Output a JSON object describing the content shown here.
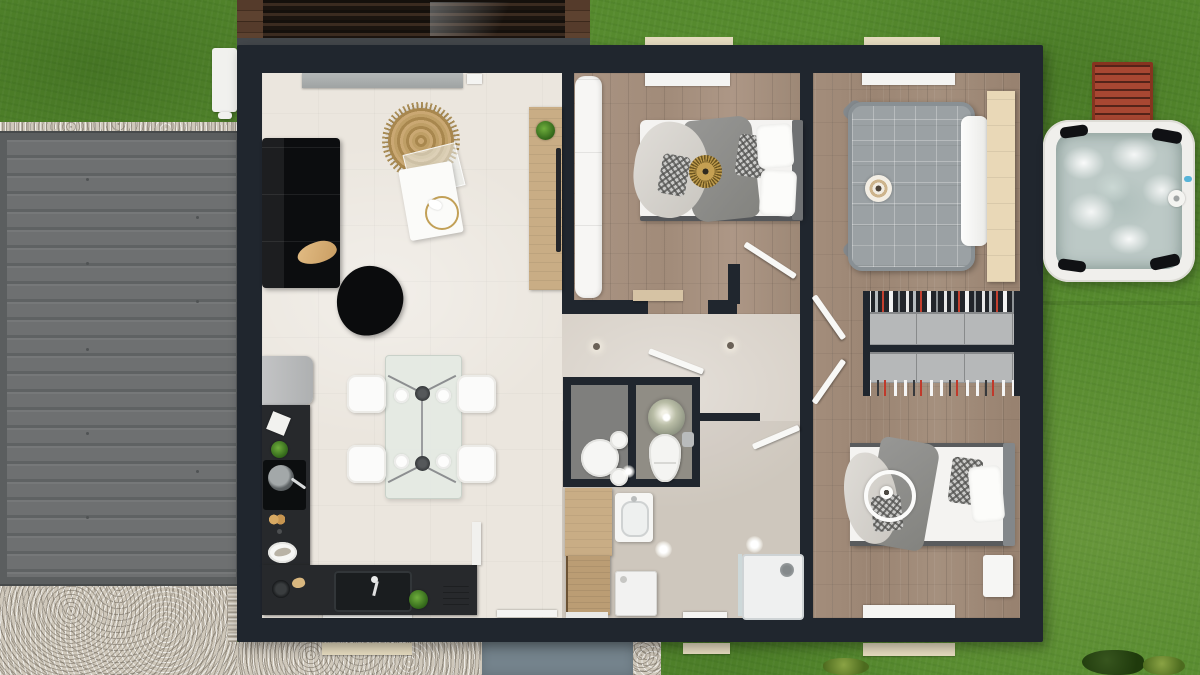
{
  "colors": {
    "grass": "#568a2e",
    "gravel": "#cfc8bb",
    "path": "#74838c",
    "wall": "#20262e",
    "floor-cream": "#ebe6de",
    "floor-hall": "#d8d1c8",
    "floor-wood": "#a08a78",
    "floor-wood-b1": "#a8927f",
    "wc-a": "#7f7f7d",
    "wc-b": "#908d85",
    "counter": "#27292c",
    "sofa": "#0c0d0f",
    "wood-furn": "#c9ad85",
    "sill": "#e6dcc0",
    "garage": "#6c6f70",
    "garage-frame": "#5b5e5f",
    "bench-red": "#a84732",
    "tub-rim": "#f0efec",
    "tub-water": "#bcc9c6",
    "wardrobe": "#b6b8b9",
    "bed-gray": "#9ba1a4",
    "gold": "#c2a057"
  },
  "scene": {
    "kind": "top-down 3d floor plan rendering of a single-storey house",
    "outdoor": {
      "items": [
        "lawn",
        "gravel-yard",
        "garage-flat-roof",
        "wood-pergola",
        "heat-pump-unit",
        "front-path",
        "hot-tub",
        "garden-bench",
        "shrubs",
        "window-sills"
      ]
    },
    "rooms": [
      {
        "name": "living-dining-kitchen",
        "floor": "cream-tile",
        "furniture": [
          "corner-sofa",
          "dog",
          "round-woven-rug",
          "coffee-table-set",
          "gold-ring-decor",
          "floor-pouf",
          "tv-console",
          "potted-plant",
          "fridge",
          "l-shaped-kitchen-counter",
          "induction-hob",
          "frying-pan",
          "kitchen-sink",
          "faucet",
          "toaster",
          "dining-table",
          "four-plates",
          "four-chairs",
          "two-pendant-lamps",
          "window-seat"
        ]
      },
      {
        "name": "bedroom-1",
        "floor": "wood-plank",
        "furniture": [
          "white-wardrobe",
          "double-bed",
          "gray-throw",
          "light-throw",
          "sunburst-cushion",
          "patterned-pillow",
          "white-pillows",
          "wall-bench",
          "window-seat"
        ]
      },
      {
        "name": "master-bedroom",
        "floor": "wood-plank",
        "furniture": [
          "gray-tufted-bed",
          "round-target-cushion",
          "white-sheet",
          "wood-headboard-panel"
        ]
      },
      {
        "name": "dressing-room",
        "floor": "wood-plank",
        "furniture": [
          "wardrobe-row-top",
          "wardrobe-row-bottom",
          "hanging-clothes",
          "shoe-row"
        ]
      },
      {
        "name": "bedroom-3",
        "floor": "wood-plank",
        "furniture": [
          "double-bed",
          "gray-blanket",
          "light-drape",
          "patterned-pillows",
          "white-pillow",
          "ring-pendant-light",
          "nightstand",
          "window-bench"
        ]
      },
      {
        "name": "wc-room-a",
        "floor": "dark-gray",
        "furniture": [
          "round-basin-unit"
        ]
      },
      {
        "name": "wc-room-b",
        "floor": "gray",
        "furniture": [
          "sphere-pendant-lamp",
          "toilet",
          "wall-cistern"
        ]
      },
      {
        "name": "bathroom-laundry",
        "floor": "greige",
        "furniture": [
          "tall-wood-cabinet",
          "open-front-door",
          "vanity-sink",
          "washing-machine",
          "shower-tray",
          "ceiling-lights"
        ]
      },
      {
        "name": "hallway",
        "floor": "greige",
        "furniture": [
          "ceiling-spots",
          "door-leaves"
        ]
      }
    ]
  }
}
